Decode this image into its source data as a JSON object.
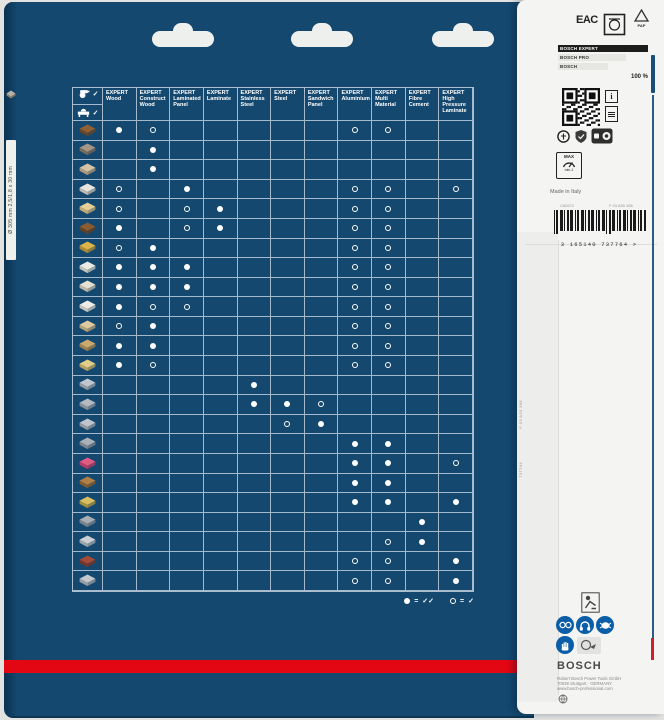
{
  "colors": {
    "navy": "#14486F",
    "bosch_red": "#e30613",
    "safety_blue": "#0a5ea8",
    "panel": "#f4f4f2",
    "dot": "#ffffff"
  },
  "side_strip": {
    "vertical_text": "Ø 305 mm  2,5/1,8 x 30 mm"
  },
  "table": {
    "corner": {
      "checks": [
        "✓",
        "✓"
      ],
      "icons": [
        "circular-saw-icon",
        "table-saw-icon"
      ]
    },
    "columns": [
      {
        "brand": "EXPERT",
        "name": "Wood"
      },
      {
        "brand": "EXPERT",
        "name": "Construct Wood"
      },
      {
        "brand": "EXPERT",
        "name": "Laminated Panel"
      },
      {
        "brand": "EXPERT",
        "name": "Laminate"
      },
      {
        "brand": "EXPERT",
        "name": "Stainless Steel"
      },
      {
        "brand": "EXPERT",
        "name": "Steel"
      },
      {
        "brand": "EXPERT",
        "name": "Sandwich Panel"
      },
      {
        "brand": "EXPERT",
        "name": "Aluminium"
      },
      {
        "brand": "EXPERT",
        "name": "Multi Material"
      },
      {
        "brand": "EXPERT",
        "name": "Fibre Cement"
      },
      {
        "brand": "EXPERT",
        "name": "High Pressure Laminate"
      }
    ],
    "rows": [
      {
        "material": "solid-hardwood",
        "t": "#8f5f36",
        "s": "#6a4424",
        "dots": "FO.....OO.."
      },
      {
        "material": "construction-wood-nails",
        "t": "#a59685",
        "s": "#7a6a58",
        "dots": ".F........."
      },
      {
        "material": "rough-sawn-timber",
        "t": "#d6c3a4",
        "s": "#b09878",
        "dots": ".F........."
      },
      {
        "material": "coated-panel",
        "t": "#e9e6df",
        "s": "#c0bbb1",
        "dots": "O.F....OO.O"
      },
      {
        "material": "chipboard",
        "t": "#e5cf96",
        "s": "#c3ab72",
        "dots": "O.OF...OO.."
      },
      {
        "material": "hardboard",
        "t": "#8a5c34",
        "s": "#66411f",
        "dots": "F.OF...OO.."
      },
      {
        "material": "osb-board",
        "t": "#dcb34a",
        "s": "#b08a2e",
        "dots": "OF.....OO.."
      },
      {
        "material": "melamine-panel",
        "t": "#eceae3",
        "s": "#c6c3ba",
        "dots": "FFF....OO.."
      },
      {
        "material": "veneered-panel",
        "t": "#e7e1d4",
        "s": "#c0b8a5",
        "dots": "FFF....OO.."
      },
      {
        "material": "laminated-panel",
        "t": "#efece7",
        "s": "#c9c5bd",
        "dots": "FOO....OO.."
      },
      {
        "material": "plywood",
        "t": "#dec9a0",
        "s": "#b7a076",
        "dots": "OF.....OO.."
      },
      {
        "material": "parquet",
        "t": "#caa96e",
        "s": "#a2834c",
        "dots": "FF.....OO.."
      },
      {
        "material": "laminate-flooring",
        "t": "#e2cd8a",
        "s": "#b9a260",
        "dots": "FO.....OO.."
      },
      {
        "material": "aluminium-profile",
        "t": "#c2c7cd",
        "s": "#979ca3",
        "dots": "....F......"
      },
      {
        "material": "aluminium-tube",
        "t": "#b4bac1",
        "s": "#8a9097",
        "dots": "....FFO...."
      },
      {
        "material": "steel-sheet",
        "t": "#c0c5cb",
        "s": "#959aa1",
        "dots": ".....OF...."
      },
      {
        "material": "steel-profile",
        "t": "#aab0b7",
        "s": "#7f858c",
        "dots": ".......FF.."
      },
      {
        "material": "solid-surface",
        "t": "#e05a86",
        "s": "#b93a63",
        "dots": ".......FF.O"
      },
      {
        "material": "worktop",
        "t": "#b08046",
        "s": "#875d2c",
        "dots": ".......FF.."
      },
      {
        "material": "sandwich-panel",
        "t": "#d8be62",
        "s": "#a8913e",
        "dots": ".......FF.F"
      },
      {
        "material": "fibre-cement-board",
        "t": "#a7adb3",
        "s": "#7d8389",
        "dots": ".........F."
      },
      {
        "material": "plasterboard",
        "t": "#ccd0d4",
        "s": "#a0a4a8",
        "dots": "........OF."
      },
      {
        "material": "hpl-board",
        "t": "#a34a38",
        "s": "#7a3325",
        "dots": ".......OO.F"
      },
      {
        "material": "cement-tile",
        "t": "#c3c8cd",
        "s": "#989da2",
        "dots": ".......OO.F"
      }
    ]
  },
  "legend": {
    "filled_eq": "=",
    "filled_checks": "✓✓",
    "hollow_eq": "=",
    "hollow_checks": "✓"
  },
  "right_panel": {
    "eac_label": "EAC",
    "pap_label": "PAP",
    "bars": {
      "items": [
        {
          "label": "BOSCH EXPERT",
          "width": 100,
          "dark": true
        },
        {
          "label": "BOSCH PRO",
          "width": 76,
          "dark": false
        },
        {
          "label": "BOSCH",
          "width": 56,
          "dark": false
        }
      ],
      "value_label": "100 %"
    },
    "info_letter": "i",
    "max_box": {
      "line1": "MAX",
      "unit": "min-1"
    },
    "made_in": "Made in Italy",
    "code_left": "C60572",
    "code_right": "F 03 A50 386",
    "barcode_digits": "3 165140 737764 >",
    "flap_code_1": "F 03 A50 386",
    "flap_code_2": "737764",
    "bosch_logo": "BOSCH",
    "address": [
      "Robert Bosch Power Tools GmbH",
      "70538 Stuttgart · GERMANY",
      "www.bosch-professional.com"
    ]
  }
}
